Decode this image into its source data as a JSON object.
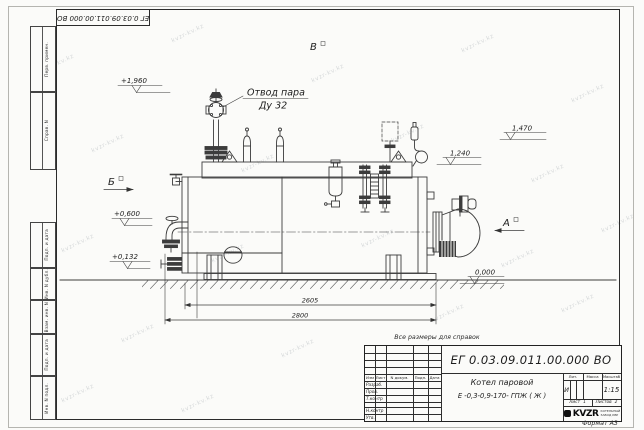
{
  "sheet": {
    "corner_stamp": "ЕГ 0.03.09.011.00.000  ВО",
    "format_label": "Формат А3",
    "watermark_text": "kvzr-kv.kz",
    "margin_labels": {
      "perv_primen": "Перв. примен.",
      "sprav_n": "Справ. N",
      "podp_data_1": "Подп. и дата",
      "inv_n_dubl": "Инв. N дубл.",
      "vzam_inv_n": "Взам. инв. N",
      "podp_data_2": "Подп. и дата",
      "inv_n_podl": "Инв. N подл."
    }
  },
  "drawing": {
    "callouts": {
      "steam_outlet_line1": "Отвод пара",
      "steam_outlet_line2": "Ду 32"
    },
    "views": {
      "a": "А",
      "b": "Б",
      "v": "В"
    },
    "elevations": {
      "top": "+1,960",
      "feed": "+0,600",
      "drain": "+0,132",
      "gauge": "1,470",
      "burner": "1,240",
      "ground": "0,000"
    },
    "dimensions": {
      "inner_length": "2605",
      "overall_length": "2800"
    }
  },
  "title_block": {
    "note": "Все размеры для справок",
    "doc_number": "ЕГ 0.03.09.011.00.000  ВО",
    "product_line1": "Котел паровой",
    "product_line2": "Е -0,3-0,9-170- ГПЖ ( Ж )",
    "columns": {
      "izm": "Изм",
      "list": "Лист",
      "n_dokum": "N докум.",
      "podp": "Подп.",
      "data": "Дата"
    },
    "rows": {
      "razrab": "Разраб.",
      "prov": "Пров.",
      "t_kontr": "Т.контр",
      "n_kontr": "Н.контр",
      "utv": "Утв."
    },
    "lit": {
      "header": "Лит.",
      "value": "И"
    },
    "massa": {
      "header": "Масса",
      "value": ""
    },
    "masshtab": {
      "header": "Масштаб",
      "value": "1:15"
    },
    "sheet_info": {
      "list_label": "Лист",
      "list_value": "1",
      "listov_label": "Листов",
      "listov_value": "2"
    },
    "logo": {
      "text": "KVZR",
      "org_line1": "КОТЕЛЬНЫЙ",
      "org_line2": "ЗАВОД КВР"
    }
  }
}
